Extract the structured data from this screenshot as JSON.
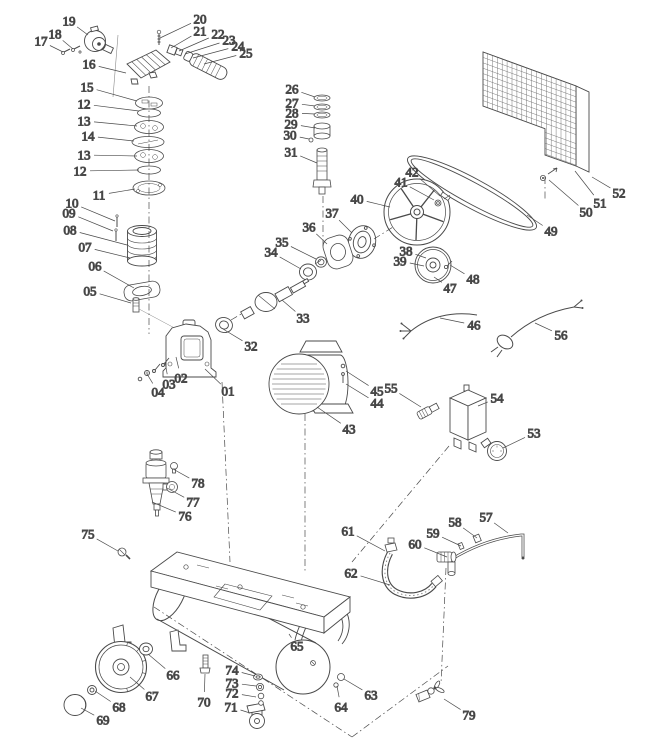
{
  "diagram": {
    "kind": "exploded-parts-diagram",
    "subject": "belt-drive air compressor parts drawing",
    "background": "#ffffff",
    "style": {
      "line_color": "#4a4a4a",
      "leader_color": "#8a8a8a",
      "dash_color": "#9a9a9a",
      "label_color": "#1b1b1b"
    },
    "labels": [
      {
        "t": "01",
        "x": 228,
        "y": 391,
        "tx": 205,
        "ty": 369
      },
      {
        "t": "02",
        "x": 181,
        "y": 378,
        "tx": 176,
        "ty": 357
      },
      {
        "t": "03",
        "x": 169,
        "y": 384,
        "tx": 165,
        "ty": 362
      },
      {
        "t": "04",
        "x": 158,
        "y": 392,
        "tx": 147,
        "ty": 374
      },
      {
        "t": "05",
        "x": 90,
        "y": 291,
        "tx": 131,
        "ty": 303
      },
      {
        "t": "06",
        "x": 95,
        "y": 266,
        "tx": 134,
        "ty": 288
      },
      {
        "t": "07",
        "x": 85,
        "y": 247,
        "tx": 130,
        "ty": 258
      },
      {
        "t": "08",
        "x": 70,
        "y": 230,
        "tx": 127,
        "ty": 245
      },
      {
        "t": "09",
        "x": 69,
        "y": 213,
        "tx": 113,
        "ty": 231
      },
      {
        "t": "10",
        "x": 72,
        "y": 203,
        "tx": 115,
        "ty": 221
      },
      {
        "t": "11",
        "x": 99,
        "y": 195,
        "tx": 135,
        "ty": 189
      },
      {
        "t": "12",
        "x": 84,
        "y": 104,
        "tx": 139,
        "ty": 111
      },
      {
        "t": "13",
        "x": 84,
        "y": 121,
        "tx": 137,
        "ty": 126
      },
      {
        "t": "14",
        "x": 88,
        "y": 136,
        "tx": 134,
        "ty": 141
      },
      {
        "t": "13",
        "x": 84,
        "y": 155,
        "tx": 137,
        "ty": 156
      },
      {
        "t": "12",
        "x": 80,
        "y": 171,
        "tx": 139,
        "ty": 170
      },
      {
        "t": "15",
        "x": 87,
        "y": 87,
        "tx": 137,
        "ty": 101
      },
      {
        "t": "16",
        "x": 89,
        "y": 64,
        "tx": 126,
        "ty": 73
      },
      {
        "t": "17",
        "x": 41,
        "y": 41,
        "tx": 63,
        "ty": 52
      },
      {
        "t": "18",
        "x": 55,
        "y": 34,
        "tx": 73,
        "ty": 49
      },
      {
        "t": "19",
        "x": 69,
        "y": 21,
        "tx": 88,
        "ty": 35
      },
      {
        "t": "20",
        "x": 200,
        "y": 19,
        "tx": 160,
        "ty": 38
      },
      {
        "t": "21",
        "x": 200,
        "y": 31,
        "tx": 171,
        "ty": 48
      },
      {
        "t": "22",
        "x": 218,
        "y": 34,
        "tx": 179,
        "ty": 51
      },
      {
        "t": "23",
        "x": 229,
        "y": 40,
        "tx": 185,
        "ty": 54
      },
      {
        "t": "24",
        "x": 238,
        "y": 46,
        "tx": 193,
        "ty": 58
      },
      {
        "t": "25",
        "x": 246,
        "y": 53,
        "tx": 204,
        "ty": 64
      },
      {
        "t": "26",
        "x": 292,
        "y": 89,
        "tx": 315,
        "ty": 97
      },
      {
        "t": "27",
        "x": 292,
        "y": 103,
        "tx": 315,
        "ty": 106
      },
      {
        "t": "28",
        "x": 292,
        "y": 113,
        "tx": 315,
        "ty": 114
      },
      {
        "t": "29",
        "x": 291,
        "y": 124,
        "tx": 315,
        "ty": 128
      },
      {
        "t": "30",
        "x": 290,
        "y": 135,
        "tx": 309,
        "ty": 139
      },
      {
        "t": "31",
        "x": 291,
        "y": 152,
        "tx": 317,
        "ty": 163
      },
      {
        "t": "32",
        "x": 251,
        "y": 346,
        "tx": 223,
        "ty": 329
      },
      {
        "t": "33",
        "x": 303,
        "y": 318,
        "tx": 282,
        "ty": 300
      },
      {
        "t": "34",
        "x": 271,
        "y": 252,
        "tx": 301,
        "ty": 269
      },
      {
        "t": "35",
        "x": 282,
        "y": 242,
        "tx": 316,
        "ty": 259
      },
      {
        "t": "36",
        "x": 309,
        "y": 227,
        "tx": 327,
        "ty": 244
      },
      {
        "t": "37",
        "x": 332,
        "y": 213,
        "tx": 352,
        "ty": 233
      },
      {
        "t": "38",
        "x": 406,
        "y": 251,
        "tx": 426,
        "ty": 258
      },
      {
        "t": "39",
        "x": 400,
        "y": 261,
        "tx": 424,
        "ty": 266
      },
      {
        "t": "40",
        "x": 357,
        "y": 199,
        "tx": 390,
        "ty": 207
      },
      {
        "t": "41",
        "x": 401,
        "y": 182,
        "tx": 434,
        "ty": 200
      },
      {
        "t": "42",
        "x": 412,
        "y": 172,
        "tx": 440,
        "ty": 196
      },
      {
        "t": "43",
        "x": 349,
        "y": 429,
        "tx": 317,
        "ty": 407
      },
      {
        "t": "44",
        "x": 377,
        "y": 403,
        "tx": 346,
        "ty": 384
      },
      {
        "t": "45",
        "x": 377,
        "y": 391,
        "tx": 346,
        "ty": 371
      },
      {
        "t": "46",
        "x": 474,
        "y": 325,
        "tx": 440,
        "ty": 318
      },
      {
        "t": "47",
        "x": 450,
        "y": 288,
        "tx": 434,
        "ty": 277
      },
      {
        "t": "48",
        "x": 473,
        "y": 279,
        "tx": 450,
        "ty": 265
      },
      {
        "t": "49",
        "x": 551,
        "y": 231,
        "tx": 527,
        "ty": 215
      },
      {
        "t": "50",
        "x": 586,
        "y": 212,
        "tx": 549,
        "ty": 180
      },
      {
        "t": "51",
        "x": 600,
        "y": 203,
        "tx": 575,
        "ty": 171
      },
      {
        "t": "52",
        "x": 619,
        "y": 193,
        "tx": 592,
        "ty": 177
      },
      {
        "t": "53",
        "x": 534,
        "y": 433,
        "tx": 503,
        "ty": 448
      },
      {
        "t": "54",
        "x": 497,
        "y": 398,
        "tx": 478,
        "ty": 406
      },
      {
        "t": "55",
        "x": 391,
        "y": 388,
        "tx": 421,
        "ty": 407
      },
      {
        "t": "56",
        "x": 561,
        "y": 335,
        "tx": 535,
        "ty": 323
      },
      {
        "t": "57",
        "x": 486,
        "y": 517,
        "tx": 508,
        "ty": 533
      },
      {
        "t": "58",
        "x": 455,
        "y": 522,
        "tx": 477,
        "ty": 538
      },
      {
        "t": "59",
        "x": 433,
        "y": 533,
        "tx": 461,
        "ty": 546
      },
      {
        "t": "60",
        "x": 415,
        "y": 544,
        "tx": 447,
        "ty": 557
      },
      {
        "t": "61",
        "x": 348,
        "y": 531,
        "tx": 385,
        "ty": 551
      },
      {
        "t": "62",
        "x": 351,
        "y": 573,
        "tx": 390,
        "ty": 585
      },
      {
        "t": "63",
        "x": 371,
        "y": 695,
        "tx": 344,
        "ty": 679
      },
      {
        "t": "64",
        "x": 341,
        "y": 707,
        "tx": 337,
        "ty": 686
      },
      {
        "t": "65",
        "x": 297,
        "y": 646,
        "tx": 289,
        "ty": 634
      },
      {
        "t": "66",
        "x": 173,
        "y": 675,
        "tx": 148,
        "ty": 654
      },
      {
        "t": "67",
        "x": 152,
        "y": 696,
        "tx": 130,
        "ty": 677
      },
      {
        "t": "68",
        "x": 119,
        "y": 707,
        "tx": 95,
        "ty": 691
      },
      {
        "t": "69",
        "x": 103,
        "y": 720,
        "tx": 81,
        "ty": 708
      },
      {
        "t": "70",
        "x": 204,
        "y": 702,
        "tx": 205,
        "ty": 674
      },
      {
        "t": "71",
        "x": 231,
        "y": 707,
        "tx": 250,
        "ty": 713
      },
      {
        "t": "72",
        "x": 232,
        "y": 693,
        "tx": 256,
        "ty": 697
      },
      {
        "t": "73",
        "x": 232,
        "y": 683,
        "tx": 256,
        "ty": 686
      },
      {
        "t": "74",
        "x": 232,
        "y": 670,
        "tx": 255,
        "ty": 676
      },
      {
        "t": "75",
        "x": 88,
        "y": 534,
        "tx": 118,
        "ty": 551
      },
      {
        "t": "76",
        "x": 185,
        "y": 516,
        "tx": 152,
        "ty": 502
      },
      {
        "t": "77",
        "x": 193,
        "y": 502,
        "tx": 167,
        "ty": 488
      },
      {
        "t": "78",
        "x": 198,
        "y": 483,
        "tx": 173,
        "ty": 469
      },
      {
        "t": "79",
        "x": 469,
        "y": 715,
        "tx": 444,
        "ty": 699
      }
    ]
  }
}
